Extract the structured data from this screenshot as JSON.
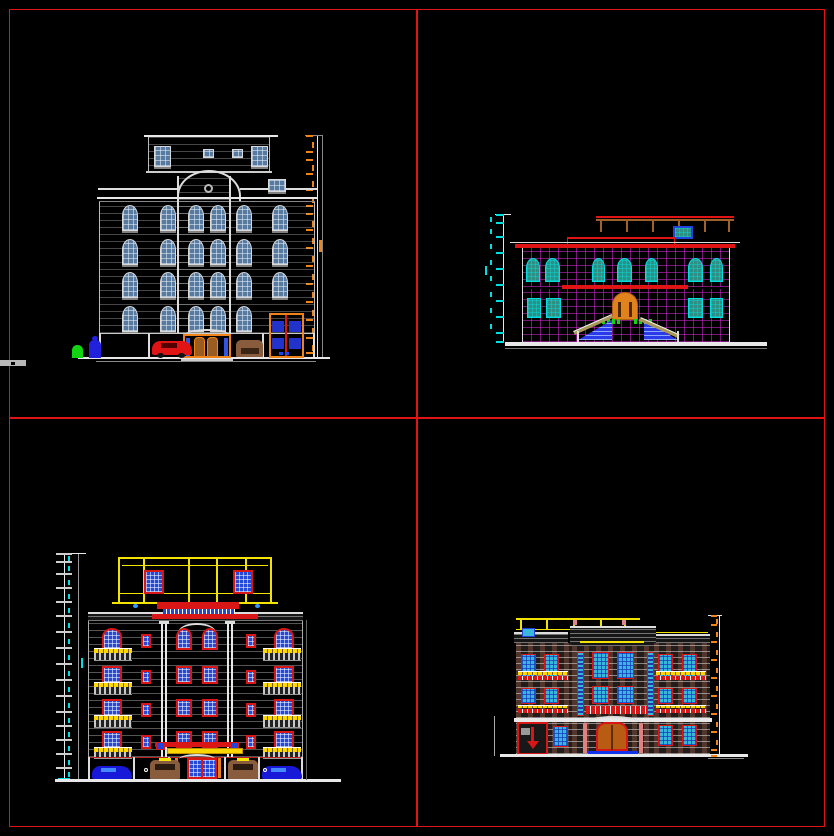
{
  "app": {
    "type": "CAD drawing viewport",
    "content": "Four architectural building elevation drawings on a black model space, separated by red construction lines",
    "background": "#000000"
  },
  "palette": {
    "red": "#e01414",
    "dred": "#d81616",
    "orange": "#f08418",
    "yellow": "#f2e400",
    "gold": "#ffd700",
    "cyan": "#00e0e0",
    "magenta": "#d82cd8",
    "green": "#12d412",
    "slate": "#567aa0",
    "blue": "#2448d8",
    "teal": "#2e8f85",
    "sky": "#38b6dc",
    "brown": "#8a5c3e",
    "tan": "#a89858",
    "white": "#e8e8e8",
    "gray": "#9a9a9a"
  },
  "layout": {
    "divider_color": "#e01414",
    "quadrants": 4
  },
  "elevations": {
    "top_left": {
      "title": "Six-storey classical elevation, white linework, slate-blue glazing",
      "floors": 6,
      "window_rows": 4,
      "window_cols": 6,
      "features": [
        "attic with dormer windows",
        "arched pediment with round medallion",
        "orange-framed entrance with double doors",
        "garage door with blue panels",
        "red car",
        "brown car",
        "green figure",
        "blue figure",
        "orange dimension chain (values illegible)"
      ]
    },
    "top_right": {
      "title": "Two-storey villa elevation, magenta grid facade, teal windows",
      "floors": 2,
      "features": [
        "roof pergola",
        "arched orange entrance door",
        "twin staircases with blue steps",
        "green shrubs",
        "red cornice bands",
        "cyan dimension chain (values illegible)"
      ]
    },
    "bottom_left": {
      "title": "Six-storey residential elevation, yellow attic frame, blue windows with red frames",
      "floors": 6,
      "window_rows": 4,
      "features": [
        "yellow attic frame with two windows",
        "red entrance pediment with blue dentils",
        "yellow balconies",
        "white columns",
        "two blue cars",
        "two brown cars",
        "blue glass entrance door",
        "cyan dimension chain (values illegible)"
      ]
    },
    "bottom_right": {
      "title": "Three-storey residential elevation, brick linework, light-blue windows with red frames",
      "floors": 3,
      "features": [
        "yellow roof pergola",
        "orange double entrance door with arch",
        "blue entry platform",
        "ramp gate with red down arrow",
        "yellow and red balcony rails",
        "orange dimension chain (values illegible)"
      ]
    }
  }
}
